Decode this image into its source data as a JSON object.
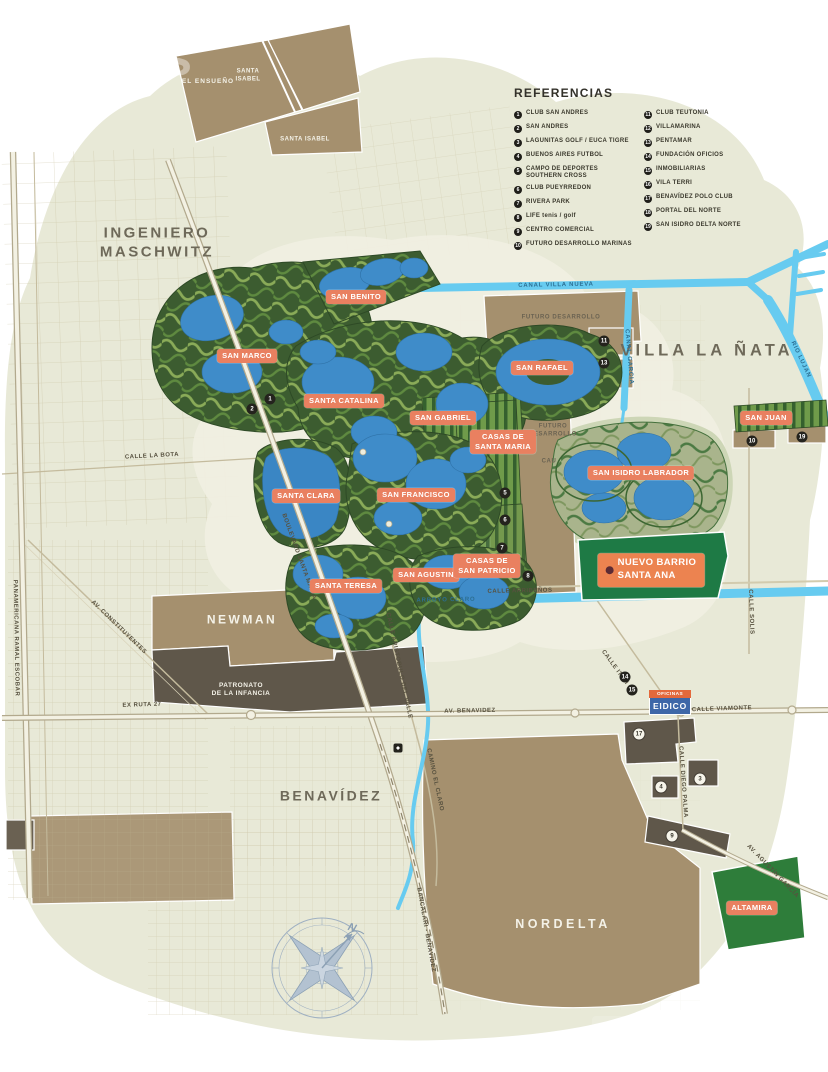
{
  "colors": {
    "background": "#e8e9d7",
    "water": "#67cbf0",
    "lagoon": "#3f8cc9",
    "community_green": "#3c5c30",
    "sage": "#a9b48c",
    "parcel_brown": "#a5906e",
    "parcel_dark": "#5f574a",
    "emerald": "#1e7a45",
    "altamira_green": "#2e7d3a",
    "pill": "#e98060",
    "road": "#f3f1e3",
    "text_grey": "#6e6959",
    "legend_text": "#3a382c",
    "compass": "#9fb0c2",
    "eidico_blue": "#3e67a8",
    "eidico_orange": "#e4693c"
  },
  "legend": {
    "title": "REFERENCIAS",
    "columns": [
      [
        {
          "n": "1",
          "label": "CLUB SAN ANDRES"
        },
        {
          "n": "2",
          "label": "SAN ANDRES"
        },
        {
          "n": "3",
          "label": "LAGUNITAS GOLF / EUCA TIGRE"
        },
        {
          "n": "4",
          "label": "BUENOS AIRES FUTBOL"
        },
        {
          "n": "5",
          "label": "CAMPO DE DEPORTES\nSOUTHERN CROSS"
        },
        {
          "n": "6",
          "label": "CLUB PUEYRREDON"
        },
        {
          "n": "7",
          "label": "RIVERA PARK"
        },
        {
          "n": "8",
          "label": "LIFE tenis / golf"
        },
        {
          "n": "9",
          "label": "CENTRO COMERCIAL"
        },
        {
          "n": "10",
          "label": "FUTURO DESARROLLO MARINAS"
        }
      ],
      [
        {
          "n": "11",
          "label": "CLUB TEUTONIA"
        },
        {
          "n": "12",
          "label": "VILLAMARINA"
        },
        {
          "n": "13",
          "label": "PENTAMAR"
        },
        {
          "n": "14",
          "label": "FUNDACIÓN OFICIOS"
        },
        {
          "n": "15",
          "label": "INMOBILIARIAS"
        },
        {
          "n": "16",
          "label": "VILA TERRI"
        },
        {
          "n": "17",
          "label": "BENAVÍDEZ POLO CLUB"
        },
        {
          "n": "18",
          "label": "PORTAL DEL NORTE"
        },
        {
          "n": "19",
          "label": "SAN ISIDRO DELTA NORTE"
        }
      ]
    ]
  },
  "watermark": "tos",
  "compass": {
    "north": "N"
  },
  "eidico": {
    "tag": "OFICINAS",
    "name": "EIDICO"
  },
  "map": {
    "area_labels": [
      {
        "lines": [
          "INGENIERO",
          "MASCHWITZ"
        ],
        "x": 157,
        "y": 243,
        "size": 15,
        "ls": 2.5
      },
      {
        "label": "VILLA LA ÑATA",
        "x": 707,
        "y": 351,
        "size": 16.5,
        "ls": 4
      },
      {
        "label": "BENAVÍDEZ",
        "x": 331,
        "y": 796,
        "size": 14,
        "ls": 2.5
      },
      {
        "label": "NORDELTA",
        "x": 563,
        "y": 925,
        "size": 12.5,
        "ls": 3.5,
        "white": true
      },
      {
        "label": "NEWMAN",
        "x": 242,
        "y": 620,
        "size": 12,
        "ls": 2.5,
        "white": true
      },
      {
        "label": "EL ENSUEÑO",
        "x": 208,
        "y": 82,
        "size": 6.5,
        "ls": 1,
        "white": true
      },
      {
        "lines": [
          "SANTA",
          "ISABEL"
        ],
        "x": 248,
        "y": 76,
        "size": 6,
        "ls": 0.5,
        "white": true
      },
      {
        "label": "SANTA ISABEL",
        "x": 305,
        "y": 140,
        "size": 6,
        "ls": 0.5,
        "white": true
      },
      {
        "lines": [
          "PATRONATO",
          "DE LA INFANCIA"
        ],
        "x": 241,
        "y": 690,
        "size": 6.5,
        "ls": 0.5,
        "white": true
      }
    ],
    "parcel_labels": [
      {
        "label": "FUTURO DESARROLLO",
        "x": 561,
        "y": 318
      },
      {
        "lines": [
          "FUTURO",
          "DESARROLLO"
        ],
        "x": 553,
        "y": 431
      },
      {
        "label": "CAU",
        "x": 549,
        "y": 462
      }
    ],
    "street_labels": [
      {
        "label": "CALLE LA BOTA",
        "x": 152,
        "y": 457,
        "rot": -3
      },
      {
        "label": "AV. CONSTITUYENTES",
        "x": 118,
        "y": 628,
        "rot": 44
      },
      {
        "label": "PANAMERICANA RAMAL ESCOBAR",
        "x": 15,
        "y": 638,
        "rot": 89
      },
      {
        "label": "EX RUTA 27",
        "x": 142,
        "y": 706,
        "rot": -2
      },
      {
        "label": "AV. BENAVIDEZ",
        "x": 470,
        "y": 712,
        "rot": -1
      },
      {
        "label": "CALLE VIAMONTE",
        "x": 722,
        "y": 710,
        "rot": -2
      },
      {
        "label": "CALLE ITATI",
        "x": 614,
        "y": 668,
        "rot": 54
      },
      {
        "label": "CALLE SOLIS",
        "x": 750,
        "y": 612,
        "rot": 88
      },
      {
        "label": "CALLE DIEGO PALMA",
        "x": 682,
        "y": 782,
        "rot": 86
      },
      {
        "label": "AV. AGUSTÍN GARCÍA",
        "x": 772,
        "y": 872,
        "rot": 46
      },
      {
        "label": "CAMINO EL CLARO",
        "x": 434,
        "y": 780,
        "rot": 78
      },
      {
        "label": "CALLE ARRIBEÑOS",
        "x": 520,
        "y": 592,
        "rot": -1
      },
      {
        "label": "BOULEVARD SANTA MARIA",
        "x": 298,
        "y": 557,
        "rot": 70
      },
      {
        "label": "CALLE ARISTOBULO DEL VALLE",
        "x": 398,
        "y": 666,
        "rot": 78
      },
      {
        "label": "BANCALARI - BENAVIDEZ",
        "x": 425,
        "y": 930,
        "rot": 80
      }
    ],
    "water_labels": [
      {
        "label": "CANAL VILLA NUEVA",
        "x": 556,
        "y": 286,
        "rot": -1
      },
      {
        "label": "CANAL GARCIA",
        "x": 628,
        "y": 357,
        "rot": 85
      },
      {
        "label": "ARROYO CLARO",
        "x": 446,
        "y": 601,
        "rot": -1
      },
      {
        "label": "RIO LUJAN",
        "x": 800,
        "y": 360,
        "rot": 65
      }
    ],
    "community_labels": [
      {
        "label": "SAN BENITO",
        "x": 356,
        "y": 297
      },
      {
        "label": "SAN MARCO",
        "x": 247,
        "y": 356
      },
      {
        "label": "SANTA CATALINA",
        "x": 344,
        "y": 401
      },
      {
        "label": "SAN RAFAEL",
        "x": 542,
        "y": 368
      },
      {
        "label": "SAN GABRIEL",
        "x": 443,
        "y": 418
      },
      {
        "lines": [
          "CASAS DE",
          "SANTA MARIA"
        ],
        "x": 503,
        "y": 442
      },
      {
        "label": "SAN JUAN",
        "x": 766,
        "y": 418
      },
      {
        "label": "SAN ISIDRO LABRADOR",
        "x": 641,
        "y": 473
      },
      {
        "label": "SANTA CLARA",
        "x": 306,
        "y": 496
      },
      {
        "label": "SAN FRANCISCO",
        "x": 416,
        "y": 495
      },
      {
        "label": "SANTA TERESA",
        "x": 346,
        "y": 586
      },
      {
        "label": "SAN AGUSTIN",
        "x": 426,
        "y": 575
      },
      {
        "lines": [
          "CASAS DE",
          "SAN PATRICIO"
        ],
        "x": 487,
        "y": 566
      },
      {
        "label": "ALTAMIRA",
        "x": 752,
        "y": 908
      }
    ],
    "special_labels": [
      {
        "lines": [
          "NUEVO BARRIO",
          "SANTA ANA"
        ],
        "x": 651,
        "y": 570,
        "big": true
      }
    ],
    "markers": [
      {
        "n": "1",
        "x": 270,
        "y": 399
      },
      {
        "n": "2",
        "x": 252,
        "y": 409
      },
      {
        "n": "11",
        "x": 604,
        "y": 341
      },
      {
        "n": "13",
        "x": 604,
        "y": 363
      },
      {
        "n": "5",
        "x": 505,
        "y": 493
      },
      {
        "n": "6",
        "x": 505,
        "y": 520
      },
      {
        "n": "7",
        "x": 502,
        "y": 548
      },
      {
        "n": "8",
        "x": 528,
        "y": 576
      },
      {
        "n": "10",
        "x": 752,
        "y": 441
      },
      {
        "n": "19",
        "x": 802,
        "y": 437
      },
      {
        "n": "14",
        "x": 625,
        "y": 677
      },
      {
        "n": "15",
        "x": 632,
        "y": 690
      },
      {
        "n": "17",
        "x": 639,
        "y": 734,
        "variant": "light"
      },
      {
        "n": "4",
        "x": 661,
        "y": 787,
        "variant": "light"
      },
      {
        "n": "3",
        "x": 700,
        "y": 779,
        "variant": "light"
      },
      {
        "n": "9",
        "x": 672,
        "y": 836,
        "variant": "light"
      },
      {
        "n": "",
        "x": 398,
        "y": 748,
        "variant": "station"
      }
    ]
  }
}
